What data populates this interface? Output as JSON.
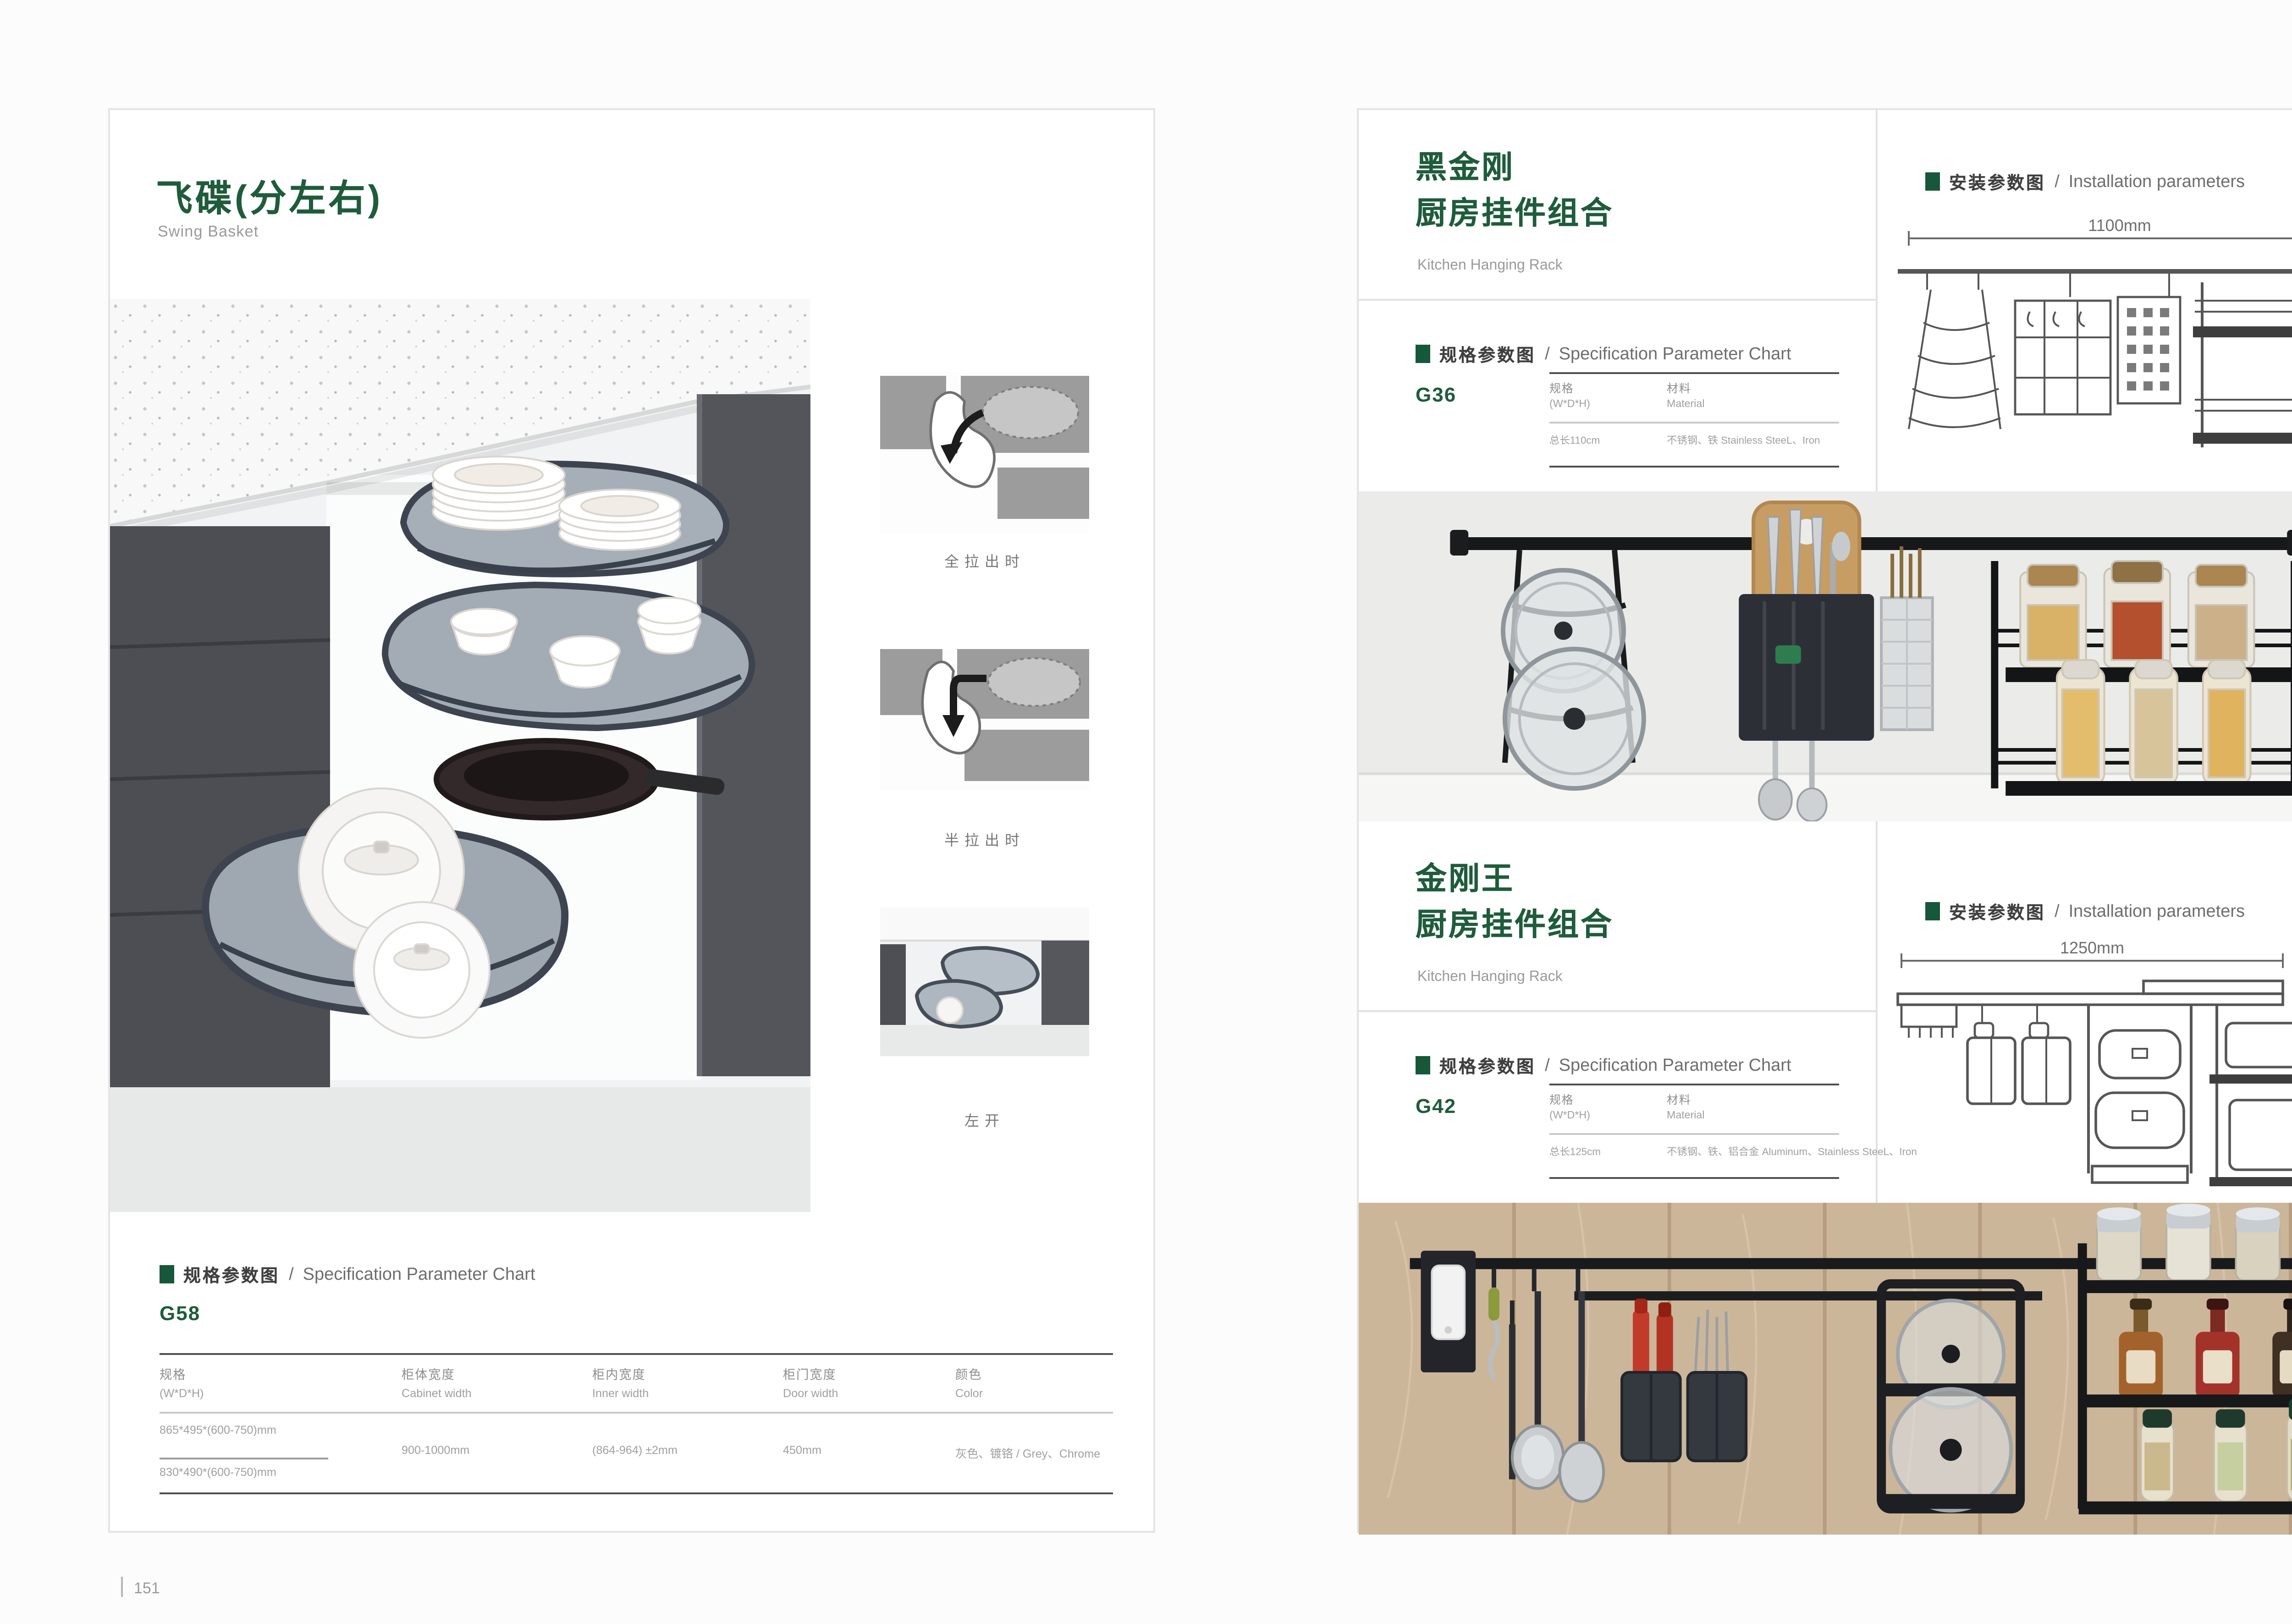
{
  "theme": {
    "accent_green": "#1E5C3B",
    "subtitle_gray": "#9a9a9a",
    "body_gray": "#8f8f8f",
    "line_dark": "#4f4f4f",
    "page_bg": "#fcfcfc"
  },
  "left_page": {
    "title": "飞碟(分左右)",
    "subtitle": "Swing Basket",
    "page_number": "151",
    "thumbnails": [
      {
        "caption": "全拉出时"
      },
      {
        "caption": "半拉出时"
      },
      {
        "caption": "左开"
      }
    ],
    "spec_section": {
      "header_cn": "规格参数图",
      "header_sep": "/",
      "header_en": "Specification Parameter Chart",
      "model": "G58",
      "columns": [
        {
          "cn": "规格",
          "en": "(W*D*H)"
        },
        {
          "cn": "柜体宽度",
          "en": "Cabinet width"
        },
        {
          "cn": "柜内宽度",
          "en": "Inner width"
        },
        {
          "cn": "柜门宽度",
          "en": "Door width"
        },
        {
          "cn": "颜色",
          "en": "Color"
        }
      ],
      "spec_value_1": "865*495*(600-750)mm",
      "spec_value_2": "830*490*(600-750)mm",
      "cabinet_width": "900-1000mm",
      "inner_width": "(864-964) ±2mm",
      "door_width": "450mm",
      "color": "灰色、镀铬 / Grey、Chrome"
    }
  },
  "right_page": {
    "page_number": "152",
    "sections": [
      {
        "title_line1": "黑金刚",
        "title_line2": "厨房挂件组合",
        "subtitle": "Kitchen Hanging Rack",
        "spec": {
          "header_cn": "规格参数图",
          "header_sep": "/",
          "header_en": "Specification Parameter Chart",
          "model": "G36",
          "col_spec_cn": "规格",
          "col_spec_en": "(W*D*H)",
          "col_mat_cn": "材料",
          "col_mat_en": "Material",
          "value_spec": "总长110cm",
          "value_mat": "不锈钢、铁  Stainless SteeL、Iron"
        },
        "install": {
          "header_cn": "安装参数图",
          "header_sep": "/",
          "header_en": "Installation parameters",
          "width_label": "1100mm",
          "height_label": "420mm"
        }
      },
      {
        "title_line1": "金刚王",
        "title_line2": "厨房挂件组合",
        "subtitle": "Kitchen Hanging Rack",
        "spec": {
          "header_cn": "规格参数图",
          "header_sep": "/",
          "header_en": "Specification Parameter Chart",
          "model": "G42",
          "col_spec_cn": "规格",
          "col_spec_en": "(W*D*H)",
          "col_mat_cn": "材料",
          "col_mat_en": "Material",
          "value_spec": "总长125cm",
          "value_mat": "不锈钢、铁、铝合金  Aluminum、Stainless SteeL、Iron"
        },
        "install": {
          "header_cn": "安装参数图",
          "header_sep": "/",
          "header_en": "Installation parameters",
          "width_label": "1250mm",
          "height_label": "430mm"
        }
      }
    ]
  }
}
